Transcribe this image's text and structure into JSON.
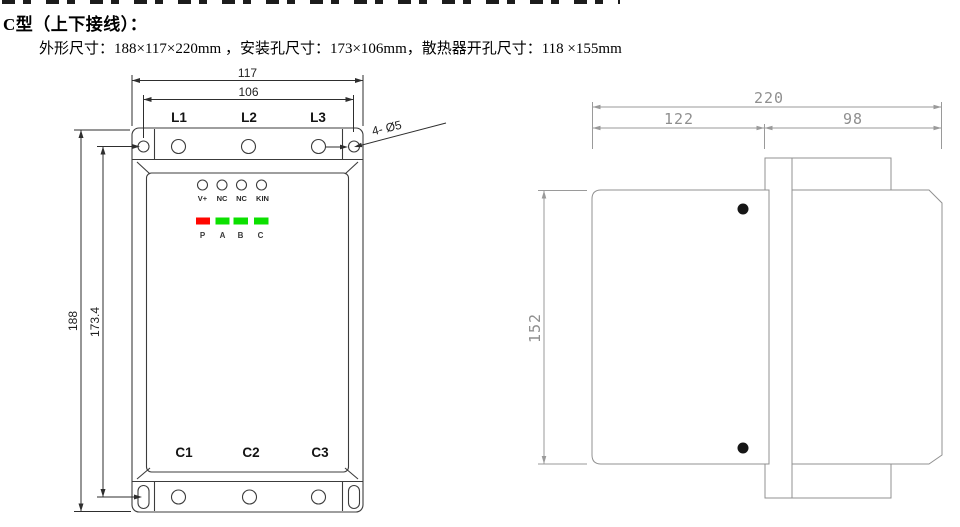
{
  "header": {
    "title": "C型（上下接线）：",
    "subtitle": "外形尺寸：188×117×220mm ，安装孔尺寸：173×106mm，散热器开孔尺寸：118 ×155mm"
  },
  "front_view": {
    "dim_width_outer": "117",
    "dim_width_holes": "106",
    "dim_height_outer": "188",
    "dim_height_holes": "173.4",
    "hole_callout": "4- Ø5",
    "input_terminals": [
      "L1",
      "L2",
      "L3"
    ],
    "output_terminals": [
      "C1",
      "C2",
      "C3"
    ],
    "port_labels": [
      "V+",
      "NC",
      "NC",
      "KIN"
    ],
    "led_labels": [
      "P",
      "A",
      "B",
      "C"
    ],
    "led_colors": [
      "#ff0600",
      "#0ce000",
      "#0ce000",
      "#0ce000"
    ]
  },
  "side_view": {
    "dim_depth_total": "220",
    "dim_depth_front": "122",
    "dim_depth_rear": "98",
    "dim_height": "152"
  }
}
